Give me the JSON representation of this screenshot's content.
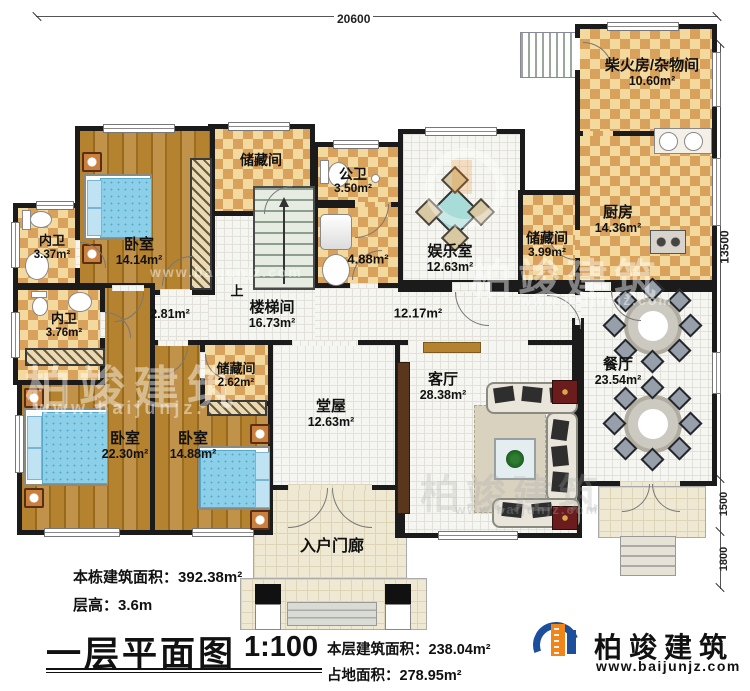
{
  "title_block": {
    "building_area_label": "本栋建筑面积：",
    "building_area_value": "392.38m²",
    "floor_height_label": "层高：",
    "floor_height_value": "3.6m",
    "title": "一层平面图",
    "scale": "1:100",
    "floor_area_label": "本层建筑面积：",
    "floor_area_value": "238.04m²",
    "footprint_label": "占地面积：",
    "footprint_value": "278.95m²"
  },
  "dimensions": {
    "top": "20600",
    "right_main": "13500",
    "right_mid": "1500",
    "right_bottom": "1800"
  },
  "rooms": {
    "firewood": {
      "name": "柴火房/杂物间",
      "area": "10.60m²"
    },
    "kitchen": {
      "name": "厨房",
      "area": "14.36m²"
    },
    "storage_right": {
      "name": "储藏间",
      "area": "3.99m²"
    },
    "dining": {
      "name": "餐厅",
      "area": "23.54m²"
    },
    "entertainment": {
      "name": "娱乐室",
      "area": "12.63m²"
    },
    "public_bath": {
      "name": "公卫",
      "area": "3.50m²"
    },
    "utility_area": "4.88m²",
    "storage_top": {
      "name": "储藏间"
    },
    "bedroom_top": {
      "name": "卧室",
      "area": "14.14m²"
    },
    "ensuite_top": {
      "name": "内卫",
      "area": "3.37m²"
    },
    "ensuite_mid": {
      "name": "内卫",
      "area": "3.76m²"
    },
    "stair_hall": {
      "name": "楼梯间",
      "area": "16.73m²"
    },
    "hall_west_area": "2.81m²",
    "hall_area": "12.17m²",
    "storage_center": {
      "name": "储藏间",
      "area": "2.62m²"
    },
    "bedroom_left": {
      "name": "卧室",
      "area": "22.30m²"
    },
    "bedroom_mid": {
      "name": "卧室",
      "area": "14.88m²"
    },
    "main_hall": {
      "name": "堂屋",
      "area": "12.63m²"
    },
    "living": {
      "name": "客厅",
      "area": "28.38m²"
    },
    "porch": {
      "name": "入户门廊"
    },
    "stairs_up": "上"
  },
  "logo": {
    "name": "柏竣建筑",
    "url": "www.baijunjz.com"
  },
  "watermark": {
    "brand": "柏竣建筑",
    "url": "www.baijunjz.com",
    "url_short": "www.baijunjz."
  },
  "colors": {
    "wall": "#1b1b1b",
    "checker_light": "#f4d99f",
    "checker_dark": "#d8a25c",
    "wood": "#ad7c2e",
    "tile": "#f5f5f1",
    "porch": "#efe9d4",
    "bed_blue": "#8ccfe8",
    "logo_blue": "#1b4f9c",
    "logo_orange": "#f08519"
  }
}
